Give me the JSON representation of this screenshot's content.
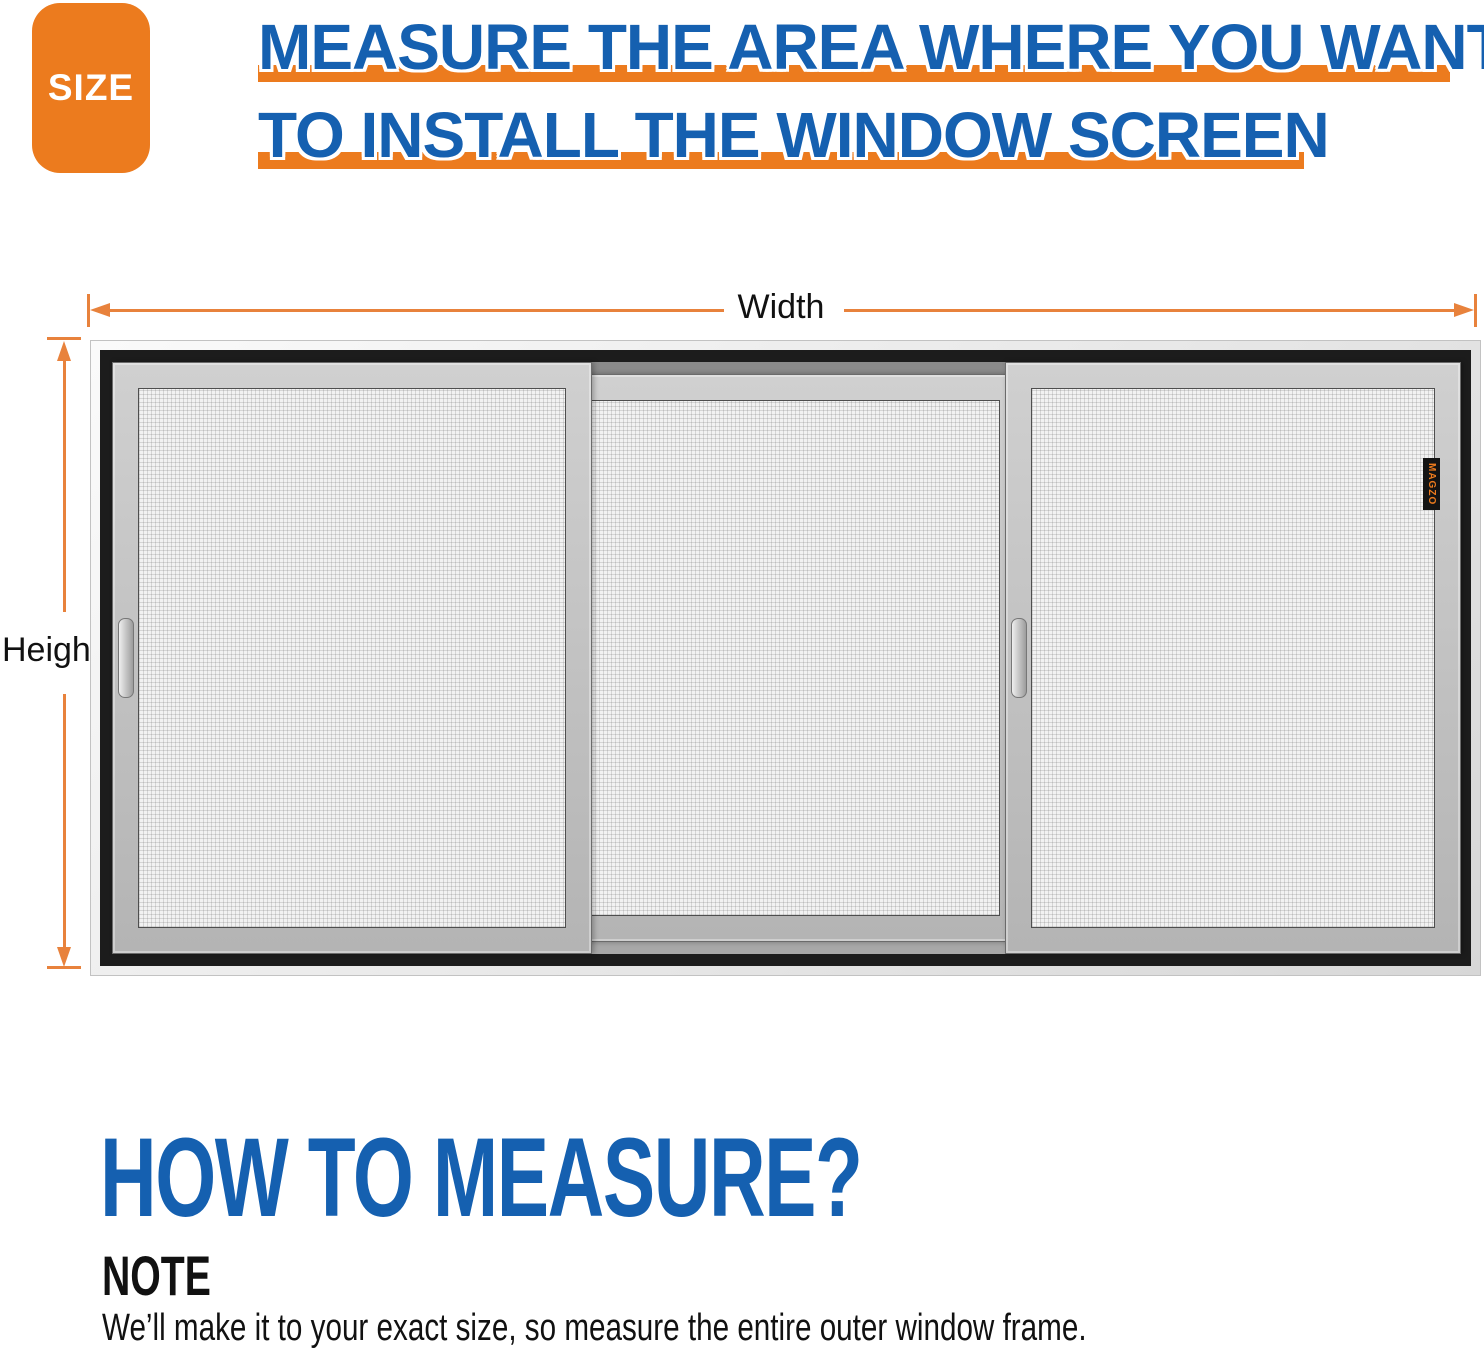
{
  "infographic": {
    "badge": {
      "label": "SIZE"
    },
    "title": {
      "line1": "MEASURE THE AREA WHERE YOU WANT",
      "line2": "TO INSTALL THE WINDOW SCREEN"
    },
    "diagram": {
      "width_label": "Width",
      "height_label": "Height",
      "brand_tag": "MAGZO"
    },
    "how_to": {
      "title": "HOW TO MEASURE?",
      "note_label": "NOTE",
      "note_text": "We’ll make it to your exact size, so measure the entire outer window frame."
    },
    "colors": {
      "accent_orange": "#EC7B1E",
      "accent_blue": "#1560B0",
      "arrow_orange": "#E8823C",
      "frame_black": "#1C1C1C",
      "frame_silver": "#F0F0F0",
      "panel_gray": "#C3C3C3",
      "mesh_light": "#F2F2F2",
      "mesh_dark": "#979797"
    }
  }
}
